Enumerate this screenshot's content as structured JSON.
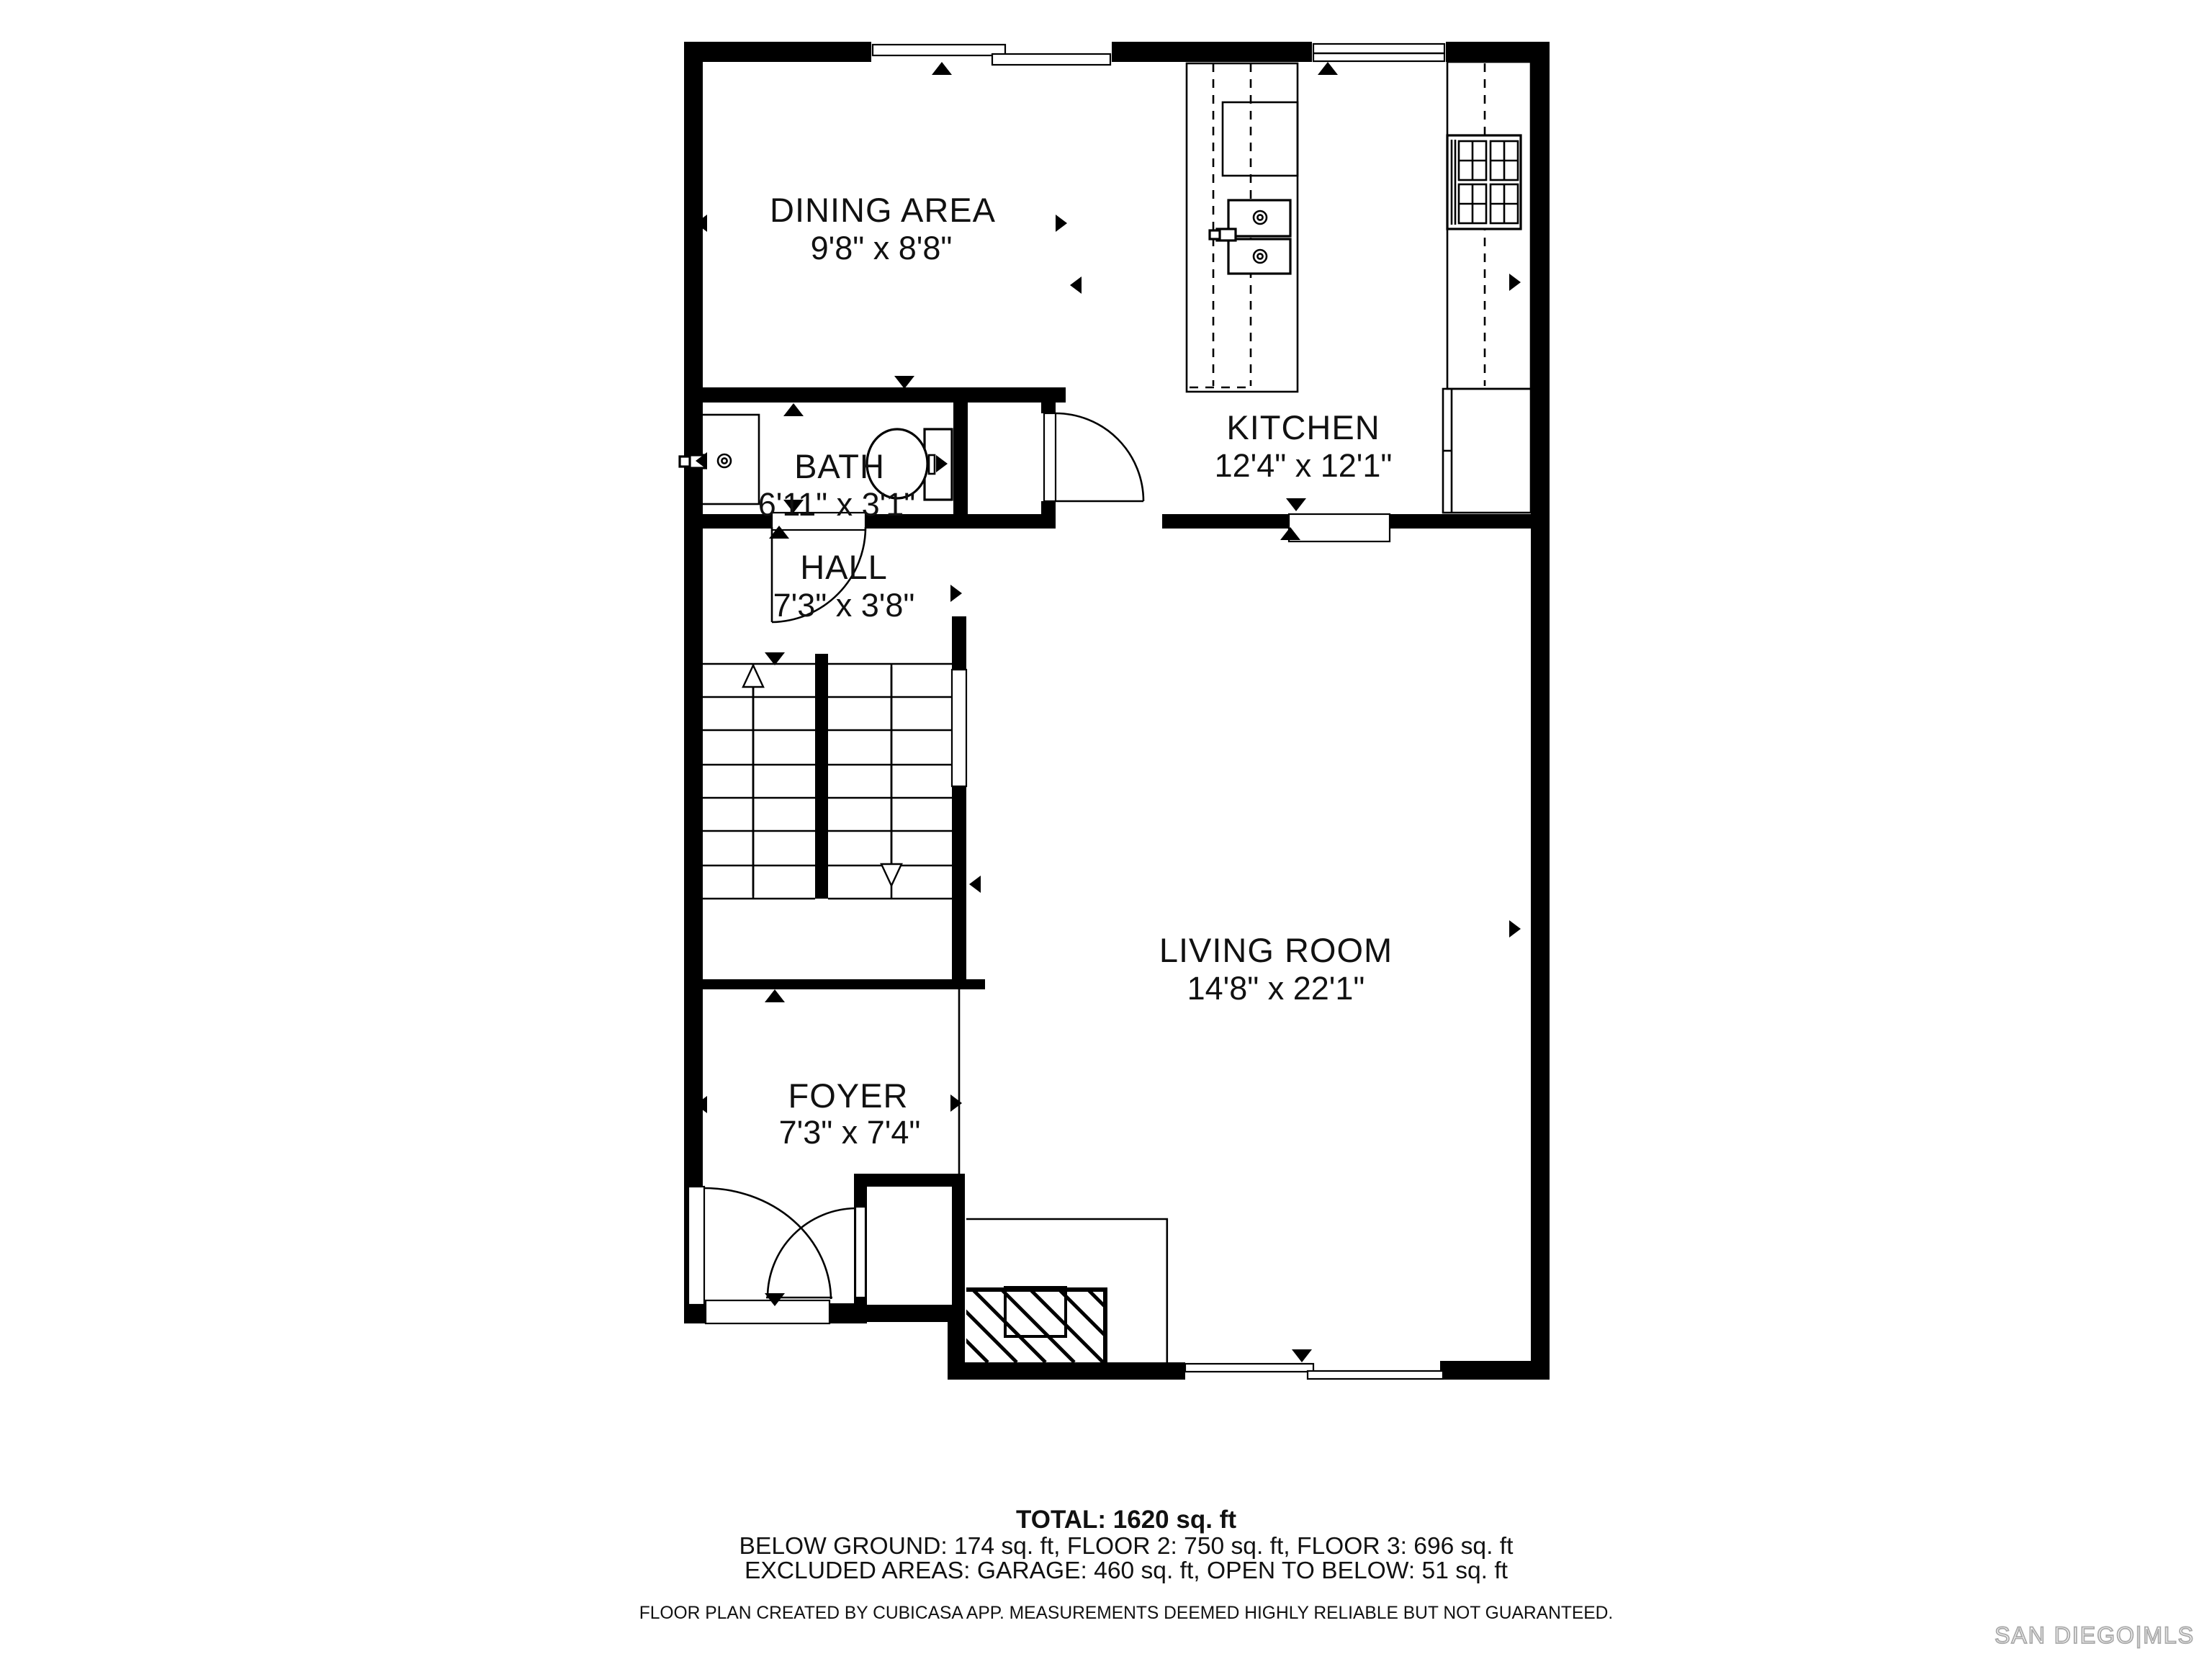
{
  "page": {
    "background_color": "#ffffff",
    "wall_color": "#000000",
    "watermark_color": "#a9a9a9"
  },
  "rooms": {
    "dining": {
      "name": "DINING AREA",
      "dims": "9'8\" x 8'8\""
    },
    "kitchen": {
      "name": "KITCHEN",
      "dims": "12'4\" x 12'1\""
    },
    "bath": {
      "name": "BATH",
      "dims": "6'11\" x 3'1\""
    },
    "hall": {
      "name": "HALL",
      "dims": "7'3\" x 3'8\""
    },
    "living": {
      "name": "LIVING ROOM",
      "dims": "14'8\" x 22'1\""
    },
    "foyer": {
      "name": "FOYER",
      "dims": "7'3\" x 7'4\""
    }
  },
  "summary": {
    "total": "TOTAL: 1620 sq. ft",
    "floors": "BELOW GROUND: 174 sq. ft, FLOOR 2: 750 sq. ft, FLOOR 3: 696 sq. ft",
    "excluded": "EXCLUDED AREAS: GARAGE: 460 sq. ft, OPEN TO BELOW: 51 sq. ft"
  },
  "footer": {
    "disclaimer": "FLOOR PLAN CREATED BY CUBICASA APP. MEASUREMENTS DEEMED HIGHLY RELIABLE BUT NOT GUARANTEED.",
    "watermark": "SAN DIEGO|MLS"
  }
}
